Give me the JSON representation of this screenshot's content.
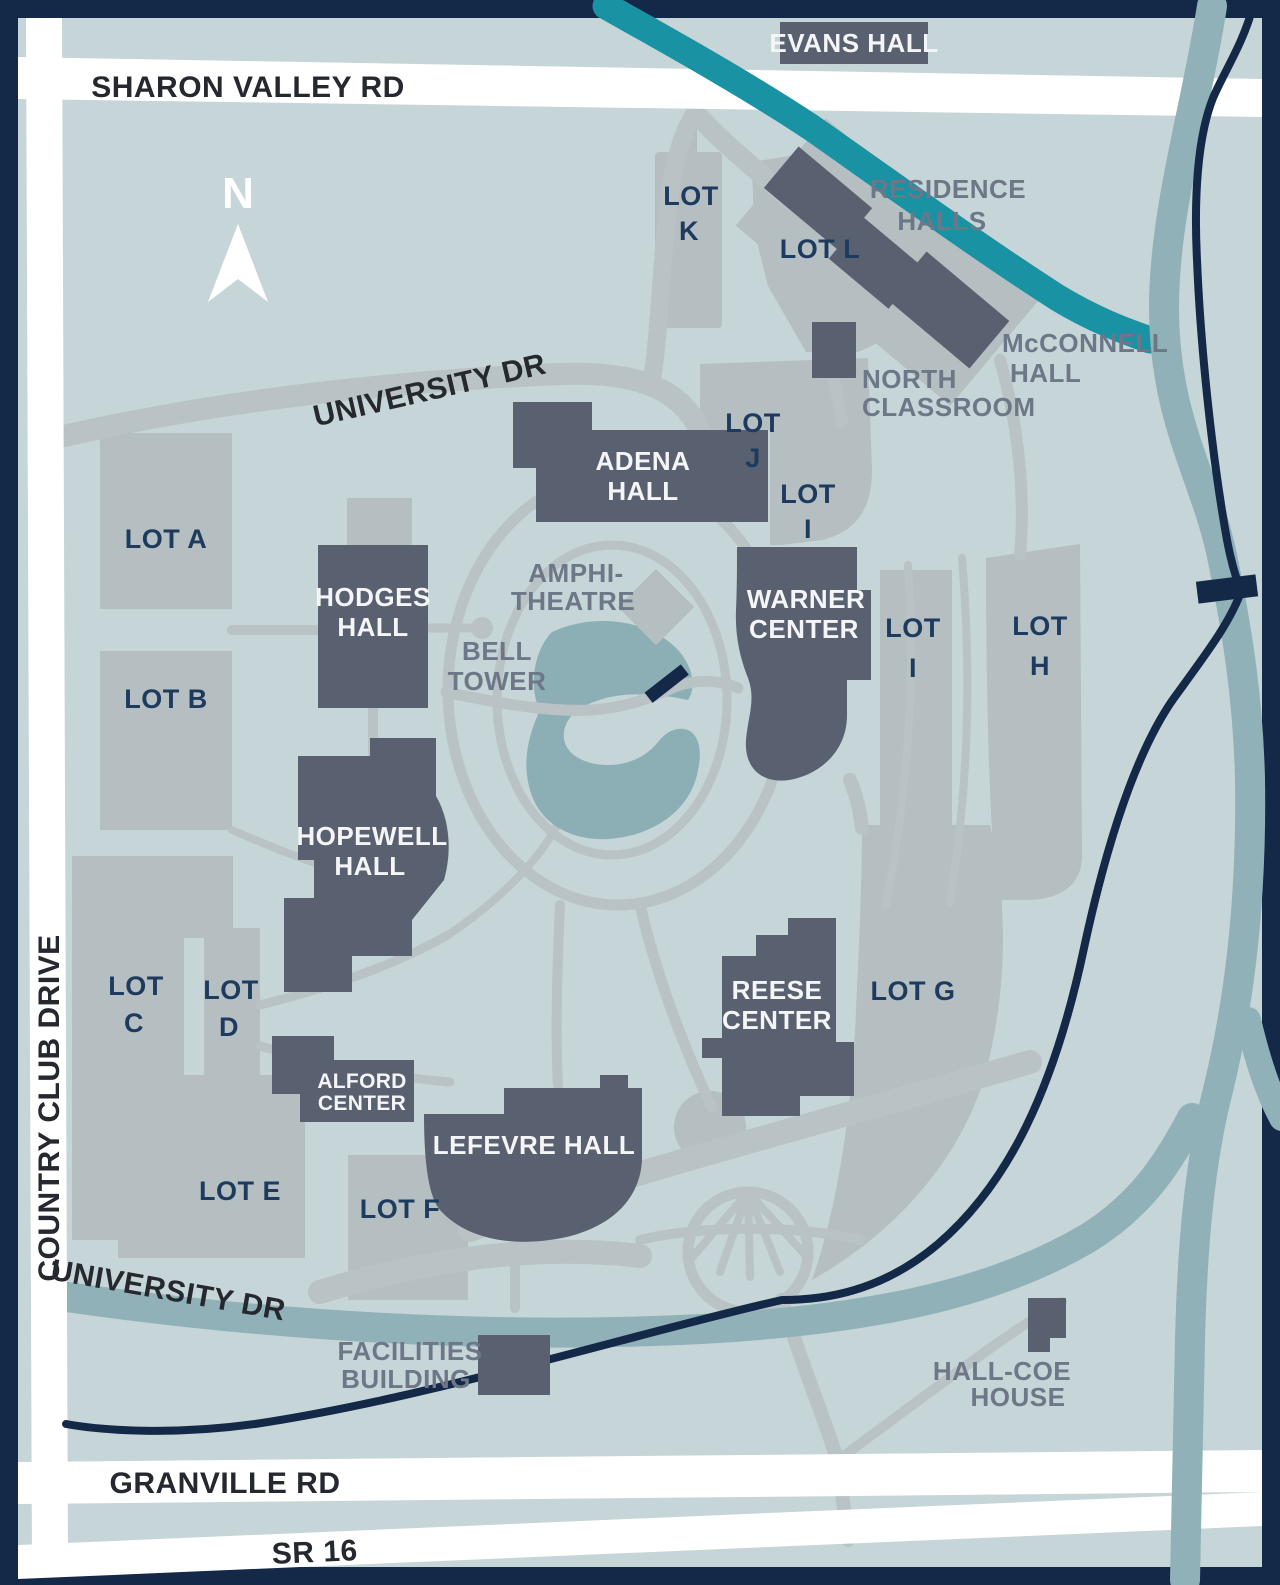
{
  "roads": {
    "sharon_valley_rd": "SHARON VALLEY RD",
    "university_dr_north": "UNIVERSITY DR",
    "university_dr_south": "UNIVERSITY DR",
    "country_club_drive": "COUNTRY CLUB DRIVE",
    "granville_rd": "GRANVILLE RD",
    "sr_16": "SR 16"
  },
  "compass": {
    "north": "N"
  },
  "buildings": {
    "evans_hall": {
      "label": "EVANS HALL"
    },
    "adena_hall": {
      "line1": "ADENA",
      "line2": "HALL"
    },
    "hodges_hall": {
      "line1": "HODGES",
      "line2": "HALL"
    },
    "warner_center": {
      "line1": "WARNER",
      "line2": "CENTER"
    },
    "hopewell_hall": {
      "line1": "HOPEWELL",
      "line2": "HALL"
    },
    "alford_center": {
      "line1": "ALFORD",
      "line2": "CENTER"
    },
    "lefevre_hall": {
      "label": "LEFEVRE HALL"
    },
    "reese_center": {
      "line1": "REESE",
      "line2": "CENTER"
    },
    "residence_halls": {
      "line1": "RESIDENCE",
      "line2": "HALLS"
    },
    "mcconnell_hall": {
      "line1": "McCONNELL",
      "line2": "HALL"
    },
    "north_classroom": {
      "line1": "NORTH",
      "line2": "CLASSROOM"
    },
    "facilities_building": {
      "line1": "FACILITIES",
      "line2": "BUILDING"
    },
    "hall_coe_house": {
      "line1": "HALL-COE",
      "line2": "HOUSE"
    },
    "amphitheatre": {
      "line1": "AMPHI-",
      "line2": "THEATRE"
    },
    "bell_tower": {
      "line1": "BELL",
      "line2": "TOWER"
    }
  },
  "parking_lots": {
    "lot_a": {
      "label": "LOT A"
    },
    "lot_b": {
      "label": "LOT B"
    },
    "lot_c": {
      "line1": "LOT",
      "line2": "C"
    },
    "lot_d": {
      "line1": "LOT",
      "line2": "D"
    },
    "lot_e": {
      "label": "LOT E"
    },
    "lot_f": {
      "label": "LOT F"
    },
    "lot_g": {
      "label": "LOT G"
    },
    "lot_h": {
      "line1": "LOT",
      "line2": "H"
    },
    "lot_i_north": {
      "line1": "LOT",
      "line2": "I"
    },
    "lot_i_east": {
      "line1": "LOT",
      "line2": "I"
    },
    "lot_j": {
      "line1": "LOT",
      "line2": "J"
    },
    "lot_k": {
      "line1": "LOT",
      "line2": "K"
    },
    "lot_l": {
      "label": "LOT L"
    }
  },
  "colors": {
    "border_navy": "#142847",
    "background": "#c6d5d7",
    "parking_gray": "#b5bec1",
    "path_gray": "#b9c2c4",
    "building_slate": "#596070",
    "stream_teal": "#1992a4",
    "river_teal": "#8fb1b7",
    "pond_teal": "#8bafb5",
    "road_white": "#ffffff",
    "lot_label_navy": "#1d3a5f",
    "building_label_gray": "#6d7787",
    "road_label_dark": "#25282e"
  }
}
